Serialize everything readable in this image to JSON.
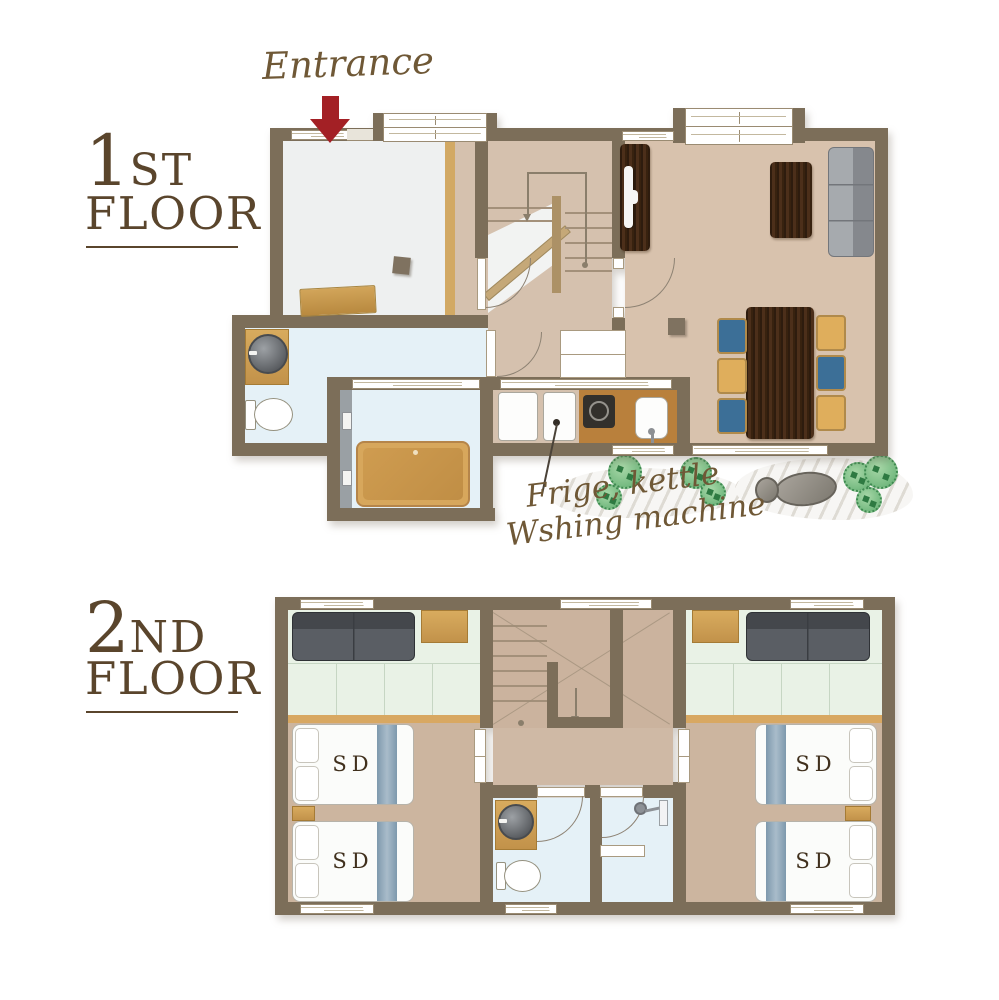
{
  "floor1": {
    "label": {
      "number": "1",
      "ordinal": "ST",
      "word": "FLOOR"
    },
    "entrance_label": "Entrance",
    "appliance_note": {
      "line1": "Frige, kettle",
      "line2": "Wshing machine"
    }
  },
  "floor2": {
    "label": {
      "number": "2",
      "ordinal": "ND",
      "word": "FLOOR"
    },
    "bed_label": "SD"
  },
  "colors": {
    "wall": "#7c6e59",
    "accent_red": "#a32025",
    "label_text": "#5a452c",
    "script_text": "#6f5836",
    "floor_entry": "#eef0f0",
    "floor_wood_hall": "#d5c1ae",
    "floor_living": "#d8c2ad",
    "floor_wet": "#e5f1f7",
    "floor_tatami": "#e9f2e6",
    "floor_bedroom": "#ccb59f",
    "chair_blue": "#3c6f97",
    "chair_yellow": "#dfae5c"
  }
}
